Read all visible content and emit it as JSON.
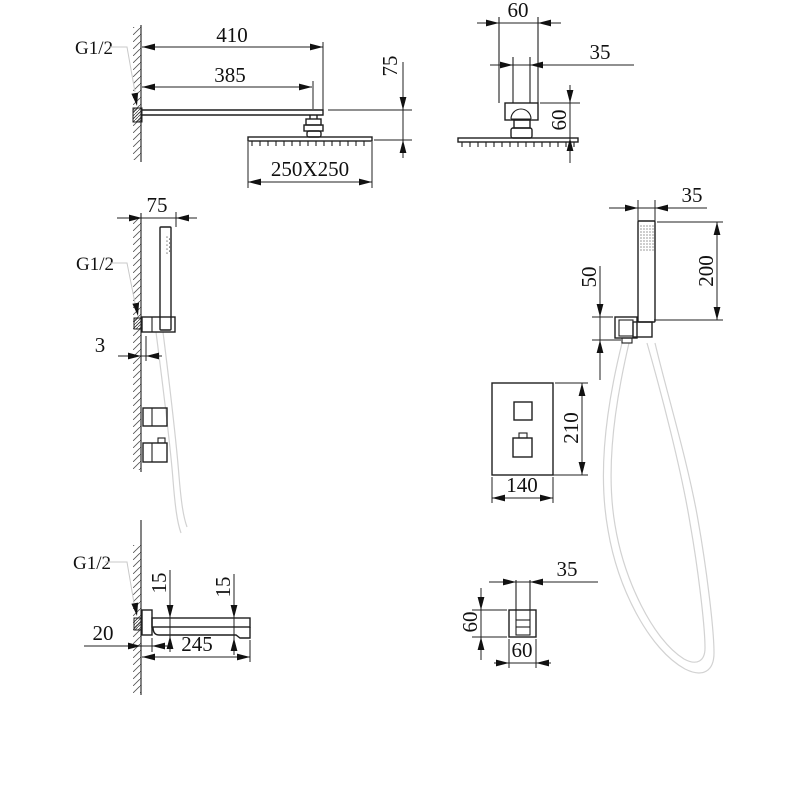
{
  "drawing": {
    "title": "shower-system-technical-drawing",
    "background": "#ffffff",
    "line_color": "#1f1f1f",
    "hose_color": "#d2d2d2",
    "views": {
      "rain_shower_side": {
        "thread": "G1/2",
        "dims": {
          "arm_length": "410",
          "arm_reach": "385",
          "head_drop": "75",
          "head_size": "250X250"
        }
      },
      "rain_shower_front": {
        "dims": {
          "flange": "60",
          "pipe": "35",
          "drop": "60"
        }
      },
      "hand_shower_side": {
        "thread": "G1/2",
        "dims": {
          "offset": "75",
          "wall_gap": "3"
        }
      },
      "hand_shower_front": {
        "dims": {
          "width": "35",
          "length": "200",
          "bracket": "50"
        }
      },
      "valve_front": {
        "dims": {
          "height": "210",
          "width": "140"
        }
      },
      "spout_side": {
        "thread": "G1/2",
        "dims": {
          "rear_height": "15",
          "front_height": "15",
          "plate_depth": "20",
          "length": "245"
        }
      },
      "spout_top": {
        "dims": {
          "pipe": "35",
          "height": "60",
          "width": "60"
        }
      }
    }
  }
}
